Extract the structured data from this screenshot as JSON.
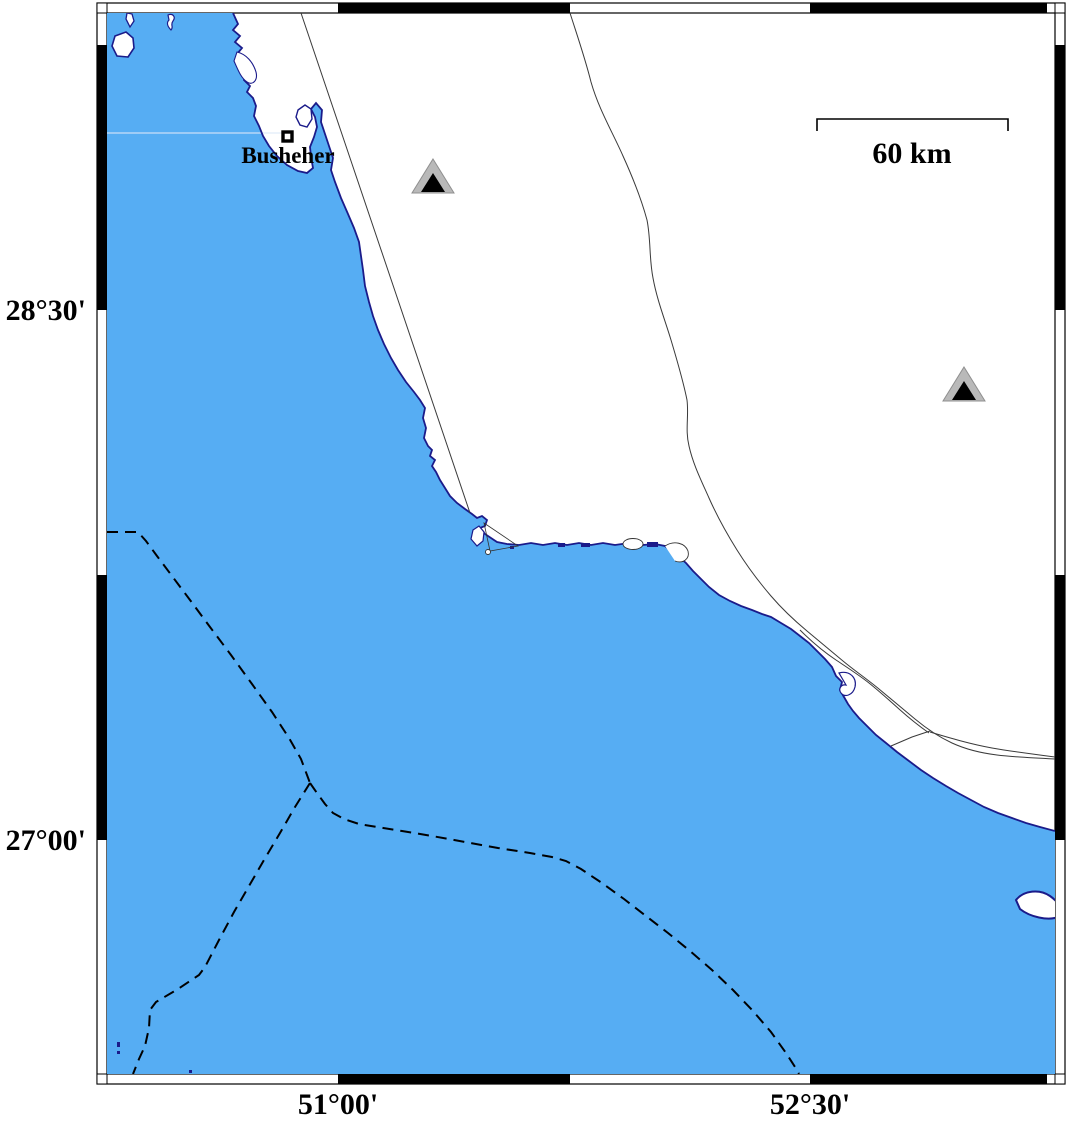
{
  "map": {
    "city": {
      "name": "Busheher",
      "marker_icon": "square-city-marker-icon"
    },
    "scale_bar": {
      "label": "60 km"
    },
    "axis": {
      "left": [
        {
          "label": "28°30'"
        },
        {
          "label": "27°00'"
        }
      ],
      "bottom": [
        {
          "label": "51°00'"
        },
        {
          "label": "52°30'"
        }
      ]
    },
    "stations": [
      {
        "icon": "station-triangle-icon"
      },
      {
        "icon": "station-triangle-icon"
      }
    ],
    "legend": {
      "dashed_line_meaning": "maritime boundary (dashed)",
      "thin_line_meaning": "road / political line"
    },
    "colors": {
      "sea": "#56ADF3",
      "coastline": "#1B1B8A",
      "land": "#FFFFFF",
      "station_fill": "#B9B9B9",
      "station_core": "#000000",
      "boundary_dash": "#000000",
      "frame": "#000000",
      "gridline": "#DDE9F8"
    }
  }
}
